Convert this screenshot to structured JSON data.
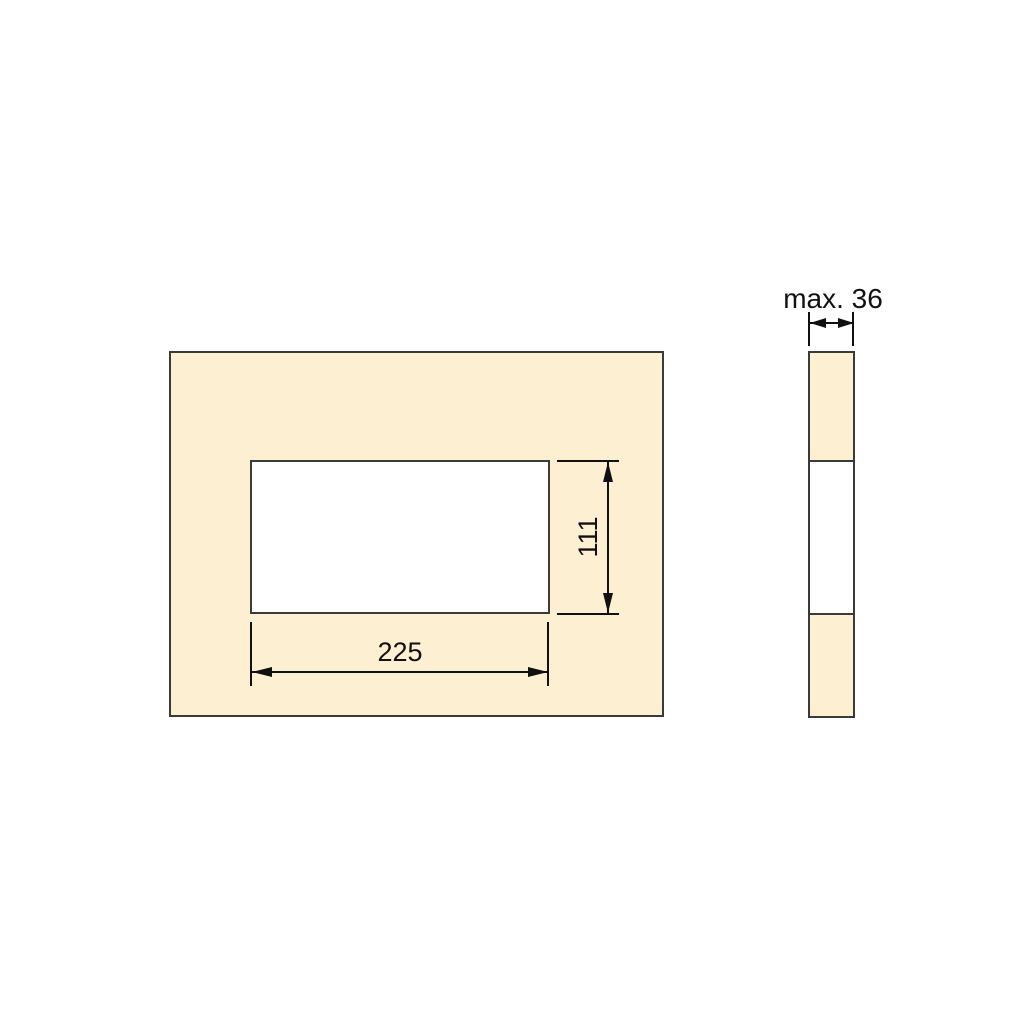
{
  "drawing": {
    "type": "technical-drawing-panel-cutout",
    "front_view": {
      "width_dimension_label": "225",
      "height_dimension_label": "111"
    },
    "side_view": {
      "thickness_dimension_label": "max. 36"
    },
    "colors": {
      "background": "#ffffff",
      "panel_fill": "#fcefd2",
      "cutout_fill": "#ffffff",
      "outline_color": "#3a3a3a",
      "dimension_color": "#111111",
      "text_color": "#111111"
    }
  }
}
